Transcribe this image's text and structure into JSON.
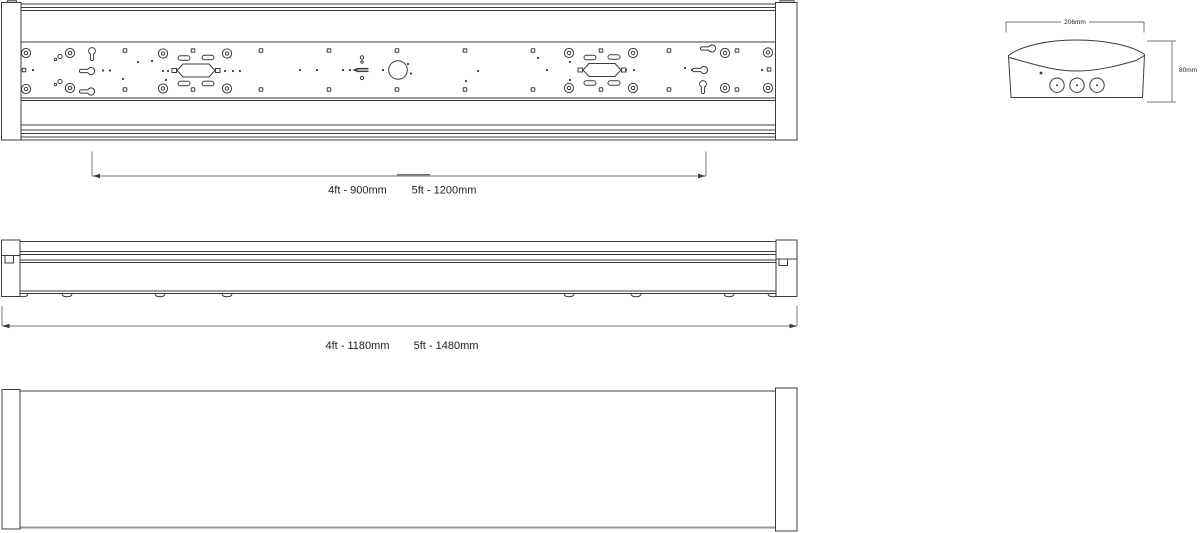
{
  "drawing": {
    "background": "#ffffff",
    "line_color": "#3c3c3c",
    "dim_line_color": "#757575",
    "text_color": "#232323",
    "views": {
      "plan": {
        "dim_4ft": "4ft - 900mm",
        "dim_5ft": "5ft - 1200mm"
      },
      "side": {
        "dim_4ft": "4ft - 1180mm",
        "dim_5ft": "5ft - 1480mm"
      },
      "end": {
        "width": "206mm",
        "height": "80mm"
      }
    }
  }
}
